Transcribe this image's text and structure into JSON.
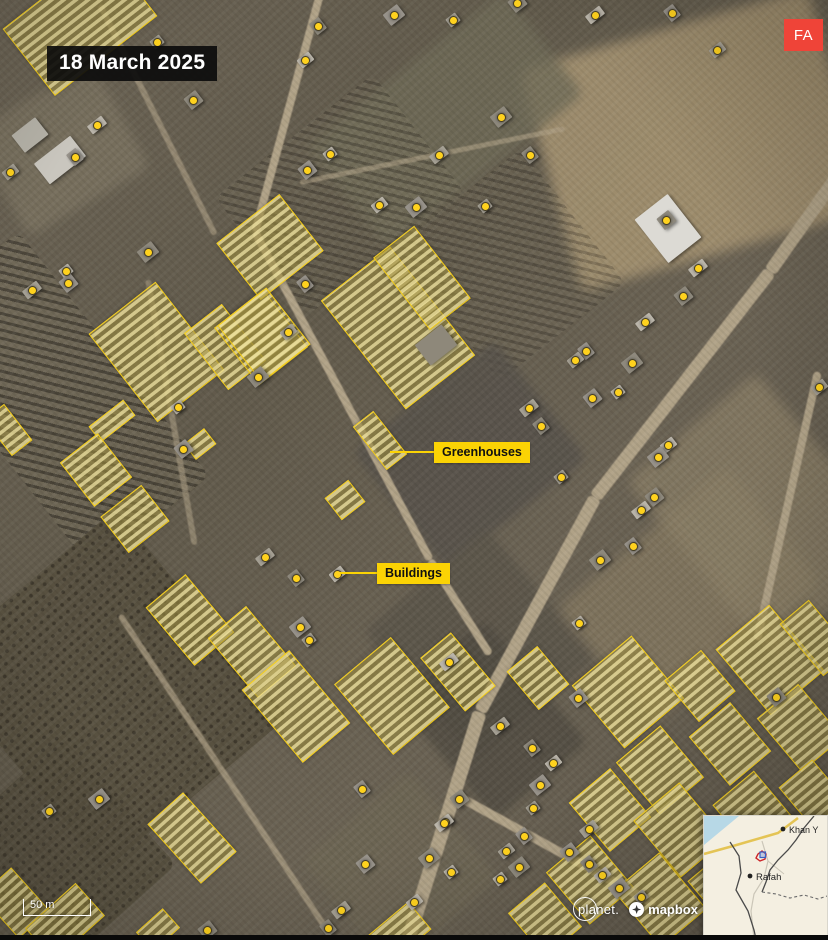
{
  "header": {
    "date_label": "18 March 2025",
    "logo_text": "FA",
    "logo_color": "#EF4438"
  },
  "callouts": {
    "greenhouses": "Greenhouses",
    "buildings": "Buildings"
  },
  "scale_bar": {
    "label": "50 m"
  },
  "attribution": {
    "planet": "planet.",
    "mapbox": "mapbox"
  },
  "inset_map": {
    "city_top": "Khan Y",
    "city_bottom": "Rafah"
  },
  "colors": {
    "annotation_yellow": "#F7CE11",
    "dot_fill": "#FFD21E",
    "dot_ring": "#463E23",
    "callout_bg": "#FBD304",
    "badge_red": "#EF4438",
    "inset_sea": "#B7D8E6",
    "inset_land": "#F4EFE1"
  },
  "map_annotations": {
    "building_dots": [
      [
        157,
        42
      ],
      [
        193,
        100
      ],
      [
        97,
        125
      ],
      [
        75,
        157
      ],
      [
        10,
        172
      ],
      [
        148,
        252
      ],
      [
        66,
        271
      ],
      [
        68,
        283
      ],
      [
        32,
        290
      ],
      [
        318,
        26
      ],
      [
        305,
        60
      ],
      [
        394,
        15
      ],
      [
        453,
        20
      ],
      [
        517,
        3
      ],
      [
        595,
        15
      ],
      [
        672,
        13
      ],
      [
        717,
        50
      ],
      [
        501,
        117
      ],
      [
        330,
        154
      ],
      [
        307,
        170
      ],
      [
        439,
        155
      ],
      [
        530,
        155
      ],
      [
        379,
        205
      ],
      [
        416,
        207
      ],
      [
        485,
        206
      ],
      [
        666,
        220
      ],
      [
        698,
        268
      ],
      [
        305,
        284
      ],
      [
        288,
        332
      ],
      [
        258,
        377
      ],
      [
        178,
        407
      ],
      [
        183,
        449
      ],
      [
        265,
        557
      ],
      [
        296,
        578
      ],
      [
        337,
        574
      ],
      [
        300,
        627
      ],
      [
        309,
        640
      ],
      [
        683,
        296
      ],
      [
        645,
        322
      ],
      [
        586,
        351
      ],
      [
        575,
        360
      ],
      [
        632,
        363
      ],
      [
        618,
        392
      ],
      [
        592,
        398
      ],
      [
        529,
        408
      ],
      [
        541,
        426
      ],
      [
        668,
        445
      ],
      [
        658,
        457
      ],
      [
        561,
        477
      ],
      [
        654,
        497
      ],
      [
        641,
        510
      ],
      [
        633,
        546
      ],
      [
        819,
        387
      ],
      [
        600,
        560
      ],
      [
        579,
        623
      ],
      [
        578,
        698
      ],
      [
        500,
        726
      ],
      [
        532,
        748
      ],
      [
        553,
        763
      ],
      [
        540,
        785
      ],
      [
        533,
        808
      ],
      [
        776,
        697
      ],
      [
        449,
        662
      ],
      [
        362,
        789
      ],
      [
        445,
        822
      ],
      [
        429,
        858
      ],
      [
        451,
        872
      ],
      [
        365,
        864
      ],
      [
        341,
        910
      ],
      [
        328,
        928
      ],
      [
        414,
        902
      ],
      [
        99,
        799
      ],
      [
        49,
        811
      ],
      [
        459,
        799
      ],
      [
        444,
        823
      ],
      [
        524,
        836
      ],
      [
        506,
        851
      ],
      [
        519,
        867
      ],
      [
        500,
        879
      ],
      [
        569,
        852
      ],
      [
        589,
        829
      ],
      [
        589,
        864
      ],
      [
        602,
        875
      ],
      [
        619,
        888
      ],
      [
        641,
        897
      ],
      [
        207,
        930
      ]
    ],
    "greenhouses": [
      [
        80,
        22,
        130,
        85,
        -38
      ],
      [
        156,
        352,
        85,
        112,
        -38
      ],
      [
        225,
        347,
        48,
        72,
        -38
      ],
      [
        261,
        337,
        62,
        73,
        -38
      ],
      [
        112,
        421,
        44,
        20,
        -38
      ],
      [
        96,
        470,
        48,
        56,
        -38
      ],
      [
        135,
        519,
        52,
        46,
        -38
      ],
      [
        200,
        444,
        26,
        20,
        -38
      ],
      [
        8,
        430,
        26,
        46,
        -38
      ],
      [
        270,
        247,
        80,
        72,
        -38
      ],
      [
        264,
        335,
        62,
        72,
        -38
      ],
      [
        398,
        328,
        88,
        138,
        -38
      ],
      [
        422,
        278,
        52,
        92,
        -38
      ],
      [
        380,
        440,
        26,
        55,
        -38
      ],
      [
        345,
        500,
        30,
        28,
        -38
      ],
      [
        190,
        620,
        52,
        76,
        -40
      ],
      [
        252,
        652,
        50,
        78,
        -40
      ],
      [
        296,
        706,
        62,
        95,
        -40
      ],
      [
        392,
        696,
        74,
        92,
        -40
      ],
      [
        458,
        672,
        40,
        70,
        -40
      ],
      [
        192,
        838,
        48,
        80,
        -42
      ],
      [
        15,
        903,
        42,
        58,
        -42
      ],
      [
        65,
        922,
        68,
        44,
        -42
      ],
      [
        158,
        930,
        36,
        26,
        -42
      ],
      [
        400,
        932,
        52,
        36,
        -40
      ],
      [
        538,
        678,
        40,
        50,
        -40
      ],
      [
        628,
        692,
        78,
        82,
        -40
      ],
      [
        700,
        686,
        48,
        54,
        -40
      ],
      [
        770,
        660,
        70,
        86,
        -40
      ],
      [
        816,
        638,
        38,
        68,
        -40
      ],
      [
        660,
        770,
        58,
        68,
        -40
      ],
      [
        730,
        744,
        54,
        64,
        -40
      ],
      [
        800,
        728,
        54,
        70,
        -40
      ],
      [
        610,
        810,
        54,
        64,
        -40
      ],
      [
        680,
        830,
        60,
        74,
        -40
      ],
      [
        755,
        814,
        54,
        68,
        -40
      ],
      [
        816,
        798,
        44,
        64,
        -40
      ],
      [
        590,
        880,
        58,
        68,
        -40
      ],
      [
        660,
        900,
        60,
        74,
        -40
      ],
      [
        730,
        890,
        54,
        68,
        -40
      ],
      [
        800,
        880,
        54,
        74,
        -40
      ],
      [
        545,
        920,
        48,
        58,
        -40
      ]
    ],
    "large_buildings": [
      [
        668,
        228,
        42,
        55,
        -38,
        "#dcdad4"
      ],
      [
        60,
        160,
        46,
        26,
        -38,
        "#c9c6be"
      ],
      [
        30,
        135,
        30,
        22,
        -38,
        "#b5b2a8"
      ],
      [
        436,
        345,
        34,
        26,
        -38,
        "#8e887a"
      ]
    ]
  }
}
